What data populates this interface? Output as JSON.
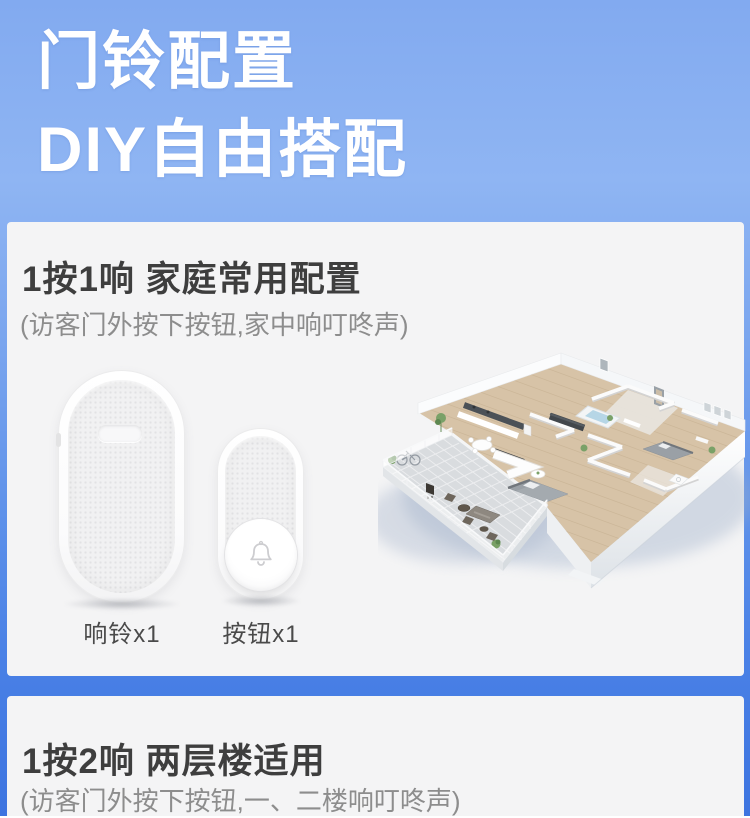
{
  "hero": {
    "title_line1": "门铃配置",
    "title_line2": "DIY自由搭配"
  },
  "section1": {
    "title": "1按1响 家庭常用配置",
    "subtitle": "(访客门外按下按钮,家中响叮咚声)",
    "devices": [
      {
        "label": "响铃x1"
      },
      {
        "label": "按钮x1"
      }
    ]
  },
  "section2": {
    "title": "1按2响 两层楼适用",
    "subtitle": "(访客门外按下按钮,一、二楼响叮咚声)"
  },
  "colors": {
    "page_gradient_top": "#8fb5f3",
    "page_gradient_bottom": "#3d74e0",
    "card_background": "#f4f4f5",
    "title_text": "#3e3e3e",
    "subtitle_text": "#8d8d8d",
    "hero_text": "#ffffff"
  }
}
